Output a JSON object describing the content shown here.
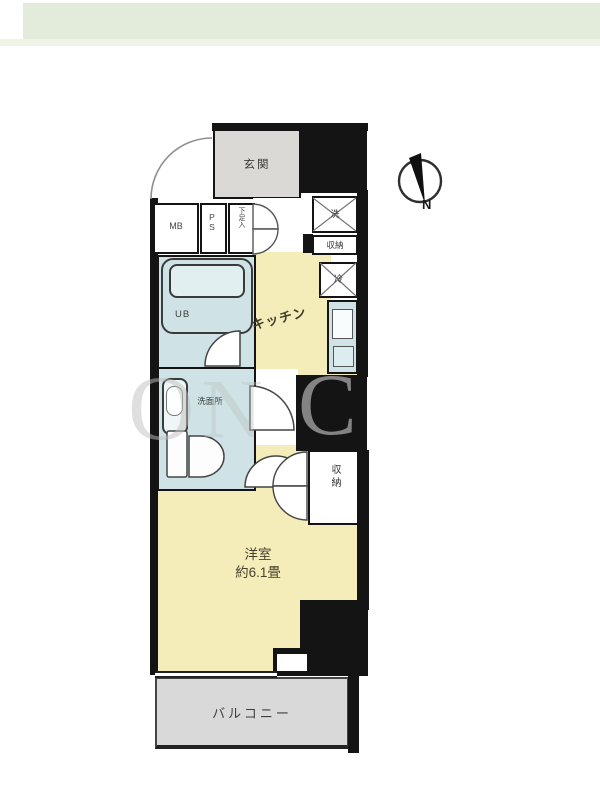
{
  "floorplan": {
    "rooms": {
      "entrance": {
        "label": "玄関"
      },
      "meter_box": {
        "label": "MB"
      },
      "pipe_space": {
        "label": "PS"
      },
      "shoe_storage": {
        "label": "下足入"
      },
      "unit_bath": {
        "label": "UB"
      },
      "washroom": {
        "label": "洗面所"
      },
      "kitchen": {
        "label": "キッチン"
      },
      "western_room": {
        "label": "洋室",
        "size": "約6.1畳"
      },
      "balcony": {
        "label": "バルコニー"
      }
    },
    "equipment": {
      "washer": {
        "label": "洗"
      },
      "fridge": {
        "label": "冷"
      }
    },
    "storage": {
      "hall_storage": {
        "label": "収納"
      },
      "room_closet": {
        "label": "収納"
      }
    },
    "compass": {
      "north": "N"
    },
    "watermark": {
      "l1": "O",
      "l2": "N",
      "l3": "C"
    },
    "colors": {
      "wall": "#141414",
      "room_yellow": "#f4edb9",
      "wet_area_blue": "#cfe3e7",
      "entrance_gray": "#dbd9d5",
      "balcony_gray": "#d9d9d9",
      "banner_green": "#e3ecda"
    }
  }
}
